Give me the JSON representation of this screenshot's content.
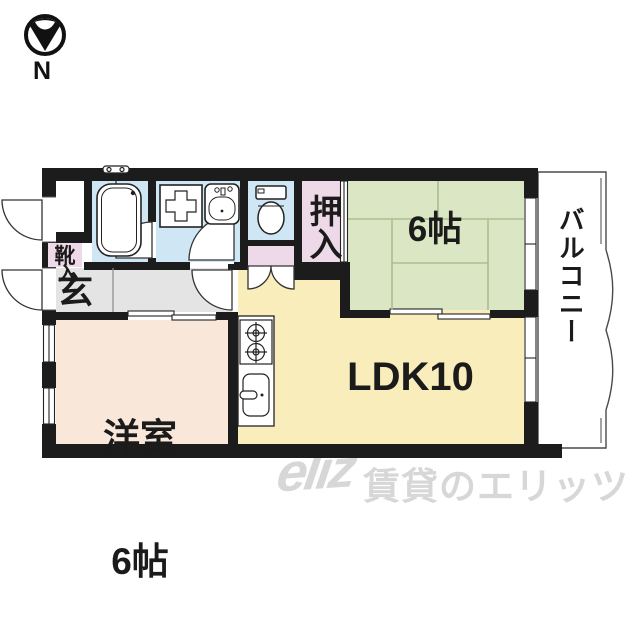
{
  "compass": {
    "label": "N",
    "icon": "north-arrow-icon"
  },
  "plan": {
    "rooms": {
      "genkan": {
        "label": "玄"
      },
      "shoe_cabinet": {
        "label": "靴",
        "label2": "入"
      },
      "oshiire": {
        "label": "押入"
      },
      "tatami_room": {
        "label": "6帖"
      },
      "balcony": {
        "label": "バルコニー"
      },
      "ldk": {
        "label": "LDK10"
      },
      "western_room": {
        "label_line1": "洋室",
        "label_line2": "6帖"
      }
    },
    "fixtures": [
      "bathtub-icon",
      "bath-faucet-icon",
      "washing-machine-pan-icon",
      "washbasin-icon",
      "toilet-icon",
      "stove-icon",
      "kitchen-sink-icon"
    ],
    "colors": {
      "wall": "#1c1c1c",
      "wet_area_blue": "#cfe7f5",
      "closet_pink": "#eed9e8",
      "tatami_green": "#dbe7c4",
      "tatami_line": "#a9bd8f",
      "ldk_yellow": "#f9edbb",
      "western_peach": "#f9e7da",
      "hall_gray": "#e4e4e4",
      "watermark_gray": "#d7d7d7"
    }
  },
  "watermark": {
    "logo": "eliz",
    "text": "賃貸のエリッツ"
  }
}
